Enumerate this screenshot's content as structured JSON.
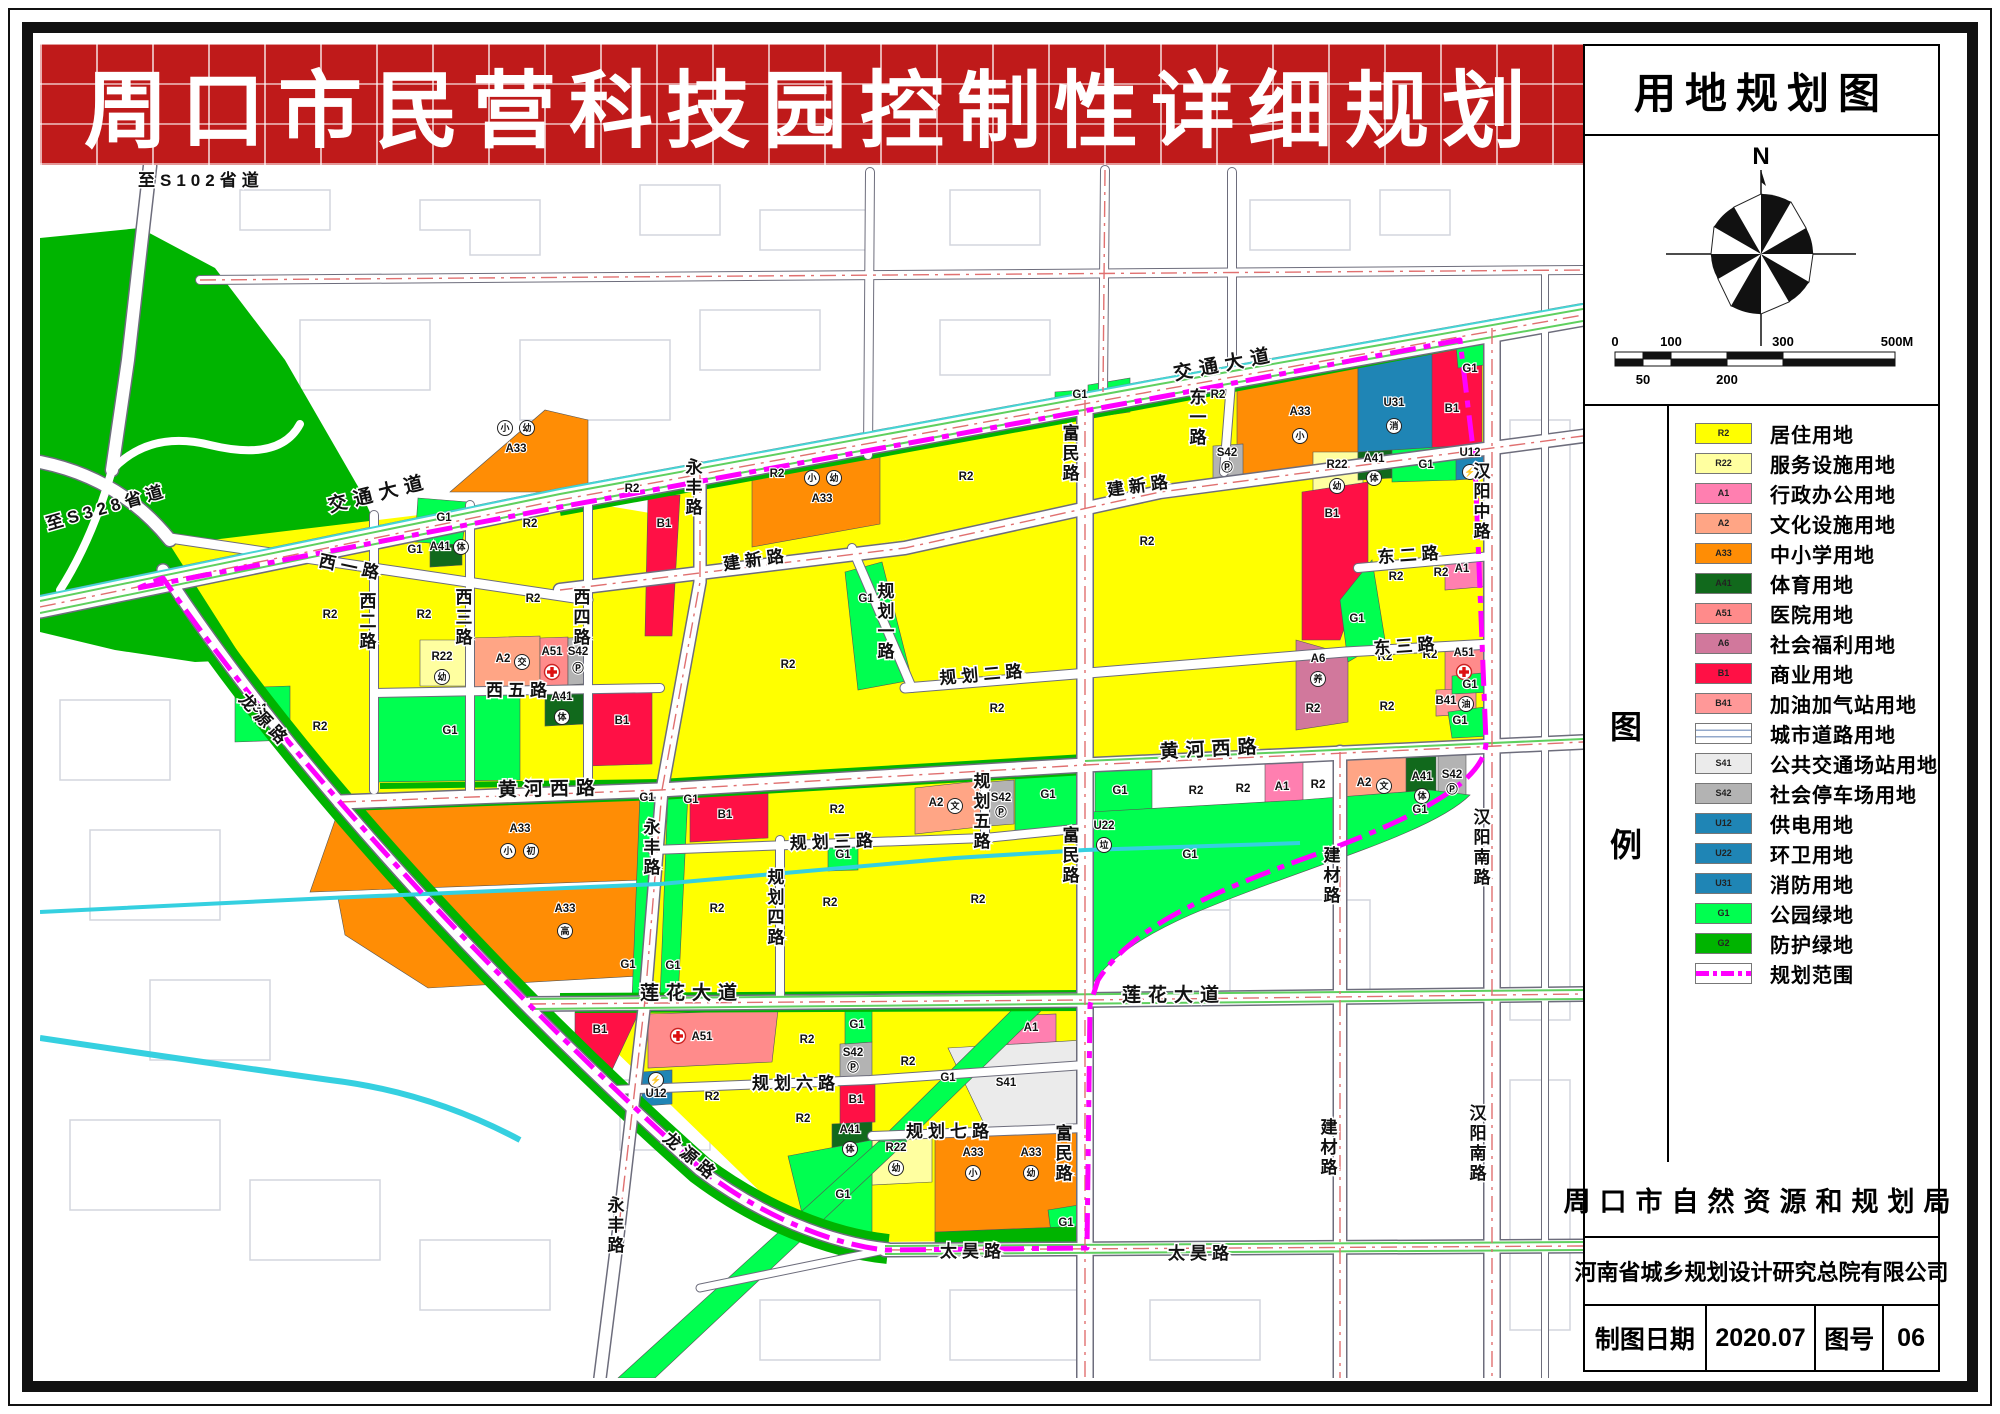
{
  "banner": {
    "title": "周口市民营科技园控制性详细规划"
  },
  "panel": {
    "title": "用地规划图",
    "compass_north": "N",
    "scale": {
      "ticks_top": [
        "0",
        "100",
        "300",
        "500M"
      ],
      "ticks_bottom": [
        "50",
        "200"
      ]
    },
    "legend_col": [
      "图",
      "例"
    ],
    "legend": [
      {
        "code": "R2",
        "color": "#ffff00",
        "label": "居住用地"
      },
      {
        "code": "R22",
        "color": "#ffffa0",
        "label": "服务设施用地"
      },
      {
        "code": "A1",
        "color": "#ff7fb0",
        "label": "行政办公用地"
      },
      {
        "code": "A2",
        "color": "#ffa585",
        "label": "文化设施用地"
      },
      {
        "code": "A33",
        "color": "#ff8d05",
        "label": "中小学用地"
      },
      {
        "code": "A41",
        "color": "#11691c",
        "label": "体育用地"
      },
      {
        "code": "A51",
        "color": "#ff8b8b",
        "label": "医院用地"
      },
      {
        "code": "A6",
        "color": "#d1789c",
        "label": "社会福利用地"
      },
      {
        "code": "B1",
        "color": "#ff1045",
        "label": "商业用地"
      },
      {
        "code": "B41",
        "color": "#ff9898",
        "label": "加油加气站用地"
      },
      {
        "code": "",
        "color": "road",
        "label": "城市道路用地"
      },
      {
        "code": "S41",
        "color": "#ebebeb",
        "label": "公共交通场站用地"
      },
      {
        "code": "S42",
        "color": "#b3b3b3",
        "label": "社会停车场用地"
      },
      {
        "code": "U12",
        "color": "#1f85b5",
        "label": "供电用地"
      },
      {
        "code": "U22",
        "color": "#1f85b5",
        "label": "环卫用地"
      },
      {
        "code": "U31",
        "color": "#1f85b5",
        "label": "消防用地"
      },
      {
        "code": "G1",
        "color": "#00ff50",
        "label": "公园绿地"
      },
      {
        "code": "G2",
        "color": "#00b400",
        "label": "防护绿地"
      },
      {
        "code": "",
        "color": "boundary",
        "label": "规划范围"
      }
    ],
    "authority": "周口市自然资源和规划局",
    "institute": "河南省城乡规划设计研究总院有限公司",
    "footer": {
      "date_label": "制图日期",
      "date_value": "2020.07",
      "sheet_label": "图号",
      "sheet_value": "06"
    }
  },
  "map": {
    "road_labels": [
      {
        "t": "至S102省道",
        "x": 138,
        "y": 186,
        "s": 20,
        "ls": 2
      },
      {
        "t": "至S328省道",
        "x": 48,
        "y": 530,
        "s": 20,
        "r": -16,
        "ls": 2
      },
      {
        "t": "交通大道",
        "x": 330,
        "y": 512,
        "r": -14,
        "big": 1
      },
      {
        "t": "交通大道",
        "x": 1175,
        "y": 380,
        "r": -11,
        "big": 1
      },
      {
        "t": "西一路",
        "x": 318,
        "y": 566,
        "r": 12
      },
      {
        "t": "西二路",
        "x": 366,
        "y": 592,
        "v": 1
      },
      {
        "t": "西三路",
        "x": 462,
        "y": 588,
        "v": 1
      },
      {
        "t": "西四路",
        "x": 580,
        "y": 588,
        "v": 1
      },
      {
        "t": "西五路",
        "x": 486,
        "y": 696
      },
      {
        "t": "永丰路",
        "x": 692,
        "y": 458,
        "v": 1
      },
      {
        "t": "永丰路",
        "x": 650,
        "y": 818,
        "v": 1
      },
      {
        "t": "永丰路",
        "x": 614,
        "y": 1196,
        "v": 1
      },
      {
        "t": "建新路",
        "x": 724,
        "y": 570,
        "r": -8
      },
      {
        "t": "建新路",
        "x": 1108,
        "y": 496,
        "r": -8
      },
      {
        "t": "规划一路",
        "x": 884,
        "y": 582,
        "v": 1
      },
      {
        "t": "规划二路",
        "x": 940,
        "y": 684,
        "r": -5
      },
      {
        "t": "黄河西路",
        "x": 498,
        "y": 796,
        "r": -1,
        "big": 1
      },
      {
        "t": "黄河西路",
        "x": 1160,
        "y": 758,
        "r": -3,
        "big": 1
      },
      {
        "t": "规划三路",
        "x": 790,
        "y": 849,
        "r": -2
      },
      {
        "t": "规划四路",
        "x": 774,
        "y": 868,
        "v": 1
      },
      {
        "t": "规划五路",
        "x": 980,
        "y": 772,
        "v": 1
      },
      {
        "t": "富民路",
        "x": 1069,
        "y": 424,
        "v": 1
      },
      {
        "t": "富民路",
        "x": 1069,
        "y": 826,
        "v": 1
      },
      {
        "t": "富民路",
        "x": 1062,
        "y": 1124,
        "v": 1
      },
      {
        "t": "莲花大道",
        "x": 640,
        "y": 999,
        "big": 1
      },
      {
        "t": "莲花大道",
        "x": 1122,
        "y": 1001,
        "big": 1
      },
      {
        "t": "规划六路",
        "x": 752,
        "y": 1089
      },
      {
        "t": "规划七路",
        "x": 906,
        "y": 1137
      },
      {
        "t": "龙源路",
        "x": 238,
        "y": 700,
        "r": 47
      },
      {
        "t": "龙源路",
        "x": 662,
        "y": 1140,
        "r": 40
      },
      {
        "t": "太昊路",
        "x": 940,
        "y": 1257
      },
      {
        "t": "太昊路",
        "x": 1168,
        "y": 1259
      },
      {
        "t": "东一路",
        "x": 1196,
        "y": 388,
        "v": 1
      },
      {
        "t": "东二路",
        "x": 1378,
        "y": 563,
        "r": -4
      },
      {
        "t": "东三路",
        "x": 1374,
        "y": 654,
        "r": -4
      },
      {
        "t": "汉阳中路",
        "x": 1480,
        "y": 462,
        "v": 1
      },
      {
        "t": "汉阳南路",
        "x": 1480,
        "y": 808,
        "v": 1
      },
      {
        "t": "汉阳南路",
        "x": 1476,
        "y": 1104,
        "v": 1
      },
      {
        "t": "建材路",
        "x": 1330,
        "y": 846,
        "v": 1
      },
      {
        "t": "建材路",
        "x": 1327,
        "y": 1118,
        "v": 1
      }
    ],
    "parcel_labels": [
      {
        "t": "G1",
        "x": 444,
        "y": 521
      },
      {
        "t": "A41",
        "x": 440,
        "y": 550
      },
      {
        "t": "体",
        "c": 1,
        "x": 461,
        "y": 547
      },
      {
        "t": "R2",
        "x": 530,
        "y": 527
      },
      {
        "t": "B1",
        "x": 664,
        "y": 527
      },
      {
        "t": "小",
        "c": 1,
        "x": 505,
        "y": 428
      },
      {
        "t": "幼",
        "c": 1,
        "x": 527,
        "y": 428
      },
      {
        "t": "A33",
        "x": 516,
        "y": 452
      },
      {
        "t": "R2",
        "x": 632,
        "y": 492
      },
      {
        "t": "R2",
        "x": 777,
        "y": 477
      },
      {
        "t": "小",
        "c": 1,
        "x": 812,
        "y": 478
      },
      {
        "t": "幼",
        "c": 1,
        "x": 834,
        "y": 478
      },
      {
        "t": "A33",
        "x": 822,
        "y": 502
      },
      {
        "t": "R2",
        "x": 966,
        "y": 480
      },
      {
        "t": "G1",
        "x": 1080,
        "y": 398
      },
      {
        "t": "R2",
        "x": 1218,
        "y": 398
      },
      {
        "t": "A33",
        "x": 1300,
        "y": 415
      },
      {
        "t": "小",
        "c": 1,
        "x": 1300,
        "y": 436
      },
      {
        "t": "S42",
        "x": 1227,
        "y": 456
      },
      {
        "t": "Ⓟ",
        "x": 1227,
        "y": 471
      },
      {
        "t": "R22",
        "x": 1337,
        "y": 468
      },
      {
        "t": "幼",
        "c": 1,
        "x": 1337,
        "y": 486
      },
      {
        "t": "U31",
        "x": 1394,
        "y": 406
      },
      {
        "t": "消",
        "c": 1,
        "x": 1394,
        "y": 426
      },
      {
        "t": "B1",
        "x": 1452,
        "y": 412
      },
      {
        "t": "G1",
        "x": 1470,
        "y": 372
      },
      {
        "t": "A41",
        "x": 1374,
        "y": 462
      },
      {
        "t": "体",
        "c": 1,
        "x": 1374,
        "y": 478
      },
      {
        "t": "G1",
        "x": 1426,
        "y": 468
      },
      {
        "t": "U12",
        "x": 1470,
        "y": 456
      },
      {
        "t": "⚡",
        "c": 1,
        "x": 1470,
        "y": 472
      },
      {
        "t": "R2",
        "x": 330,
        "y": 618
      },
      {
        "t": "R2",
        "x": 424,
        "y": 618
      },
      {
        "t": "R22",
        "x": 442,
        "y": 660
      },
      {
        "t": "幼",
        "c": 1,
        "x": 442,
        "y": 677
      },
      {
        "t": "A2",
        "x": 503,
        "y": 662
      },
      {
        "t": "交",
        "c": 1,
        "x": 522,
        "y": 662
      },
      {
        "t": "A51",
        "x": 552,
        "y": 655
      },
      {
        "t": "✚",
        "cross": 1,
        "x": 552,
        "y": 672
      },
      {
        "t": "S42",
        "x": 578,
        "y": 655
      },
      {
        "t": "Ⓟ",
        "x": 578,
        "y": 672
      },
      {
        "t": "R2",
        "x": 533,
        "y": 602
      },
      {
        "t": "G1",
        "x": 415,
        "y": 553
      },
      {
        "t": "G1",
        "x": 260,
        "y": 712
      },
      {
        "t": "R2",
        "x": 320,
        "y": 730
      },
      {
        "t": "G1",
        "x": 450,
        "y": 734
      },
      {
        "t": "A41",
        "x": 562,
        "y": 700
      },
      {
        "t": "体",
        "c": 1,
        "x": 562,
        "y": 717
      },
      {
        "t": "B1",
        "x": 622,
        "y": 724
      },
      {
        "t": "R2",
        "x": 788,
        "y": 668
      },
      {
        "t": "G1",
        "x": 866,
        "y": 602
      },
      {
        "t": "R2",
        "x": 997,
        "y": 712
      },
      {
        "t": "R2",
        "x": 1147,
        "y": 545
      },
      {
        "t": "B1",
        "x": 1332,
        "y": 517
      },
      {
        "t": "G1",
        "x": 1357,
        "y": 622
      },
      {
        "t": "A6",
        "x": 1318,
        "y": 662
      },
      {
        "t": "养",
        "c": 1,
        "x": 1318,
        "y": 679
      },
      {
        "t": "R2",
        "x": 1396,
        "y": 580
      },
      {
        "t": "R2",
        "x": 1441,
        "y": 576
      },
      {
        "t": "A1",
        "x": 1462,
        "y": 572
      },
      {
        "t": "R2",
        "x": 1385,
        "y": 660
      },
      {
        "t": "R2",
        "x": 1430,
        "y": 658
      },
      {
        "t": "A51",
        "x": 1464,
        "y": 656
      },
      {
        "t": "✚",
        "cross": 1,
        "x": 1464,
        "y": 672
      },
      {
        "t": "B41",
        "x": 1446,
        "y": 704
      },
      {
        "t": "油",
        "c": 1,
        "x": 1466,
        "y": 704
      },
      {
        "t": "G1",
        "x": 1470,
        "y": 688
      },
      {
        "t": "G1",
        "x": 1460,
        "y": 724
      },
      {
        "t": "R2",
        "x": 1313,
        "y": 712
      },
      {
        "t": "R2",
        "x": 1387,
        "y": 710
      },
      {
        "t": "G1",
        "x": 1120,
        "y": 794
      },
      {
        "t": "R2",
        "x": 1196,
        "y": 794
      },
      {
        "t": "R2",
        "x": 1243,
        "y": 792
      },
      {
        "t": "A1",
        "x": 1282,
        "y": 790
      },
      {
        "t": "R2",
        "x": 1318,
        "y": 788
      },
      {
        "t": "A2",
        "x": 1364,
        "y": 786
      },
      {
        "t": "文",
        "c": 1,
        "x": 1384,
        "y": 786
      },
      {
        "t": "A41",
        "x": 1422,
        "y": 780
      },
      {
        "t": "体",
        "c": 1,
        "x": 1422,
        "y": 796
      },
      {
        "t": "S42",
        "x": 1452,
        "y": 778
      },
      {
        "t": "Ⓟ",
        "x": 1452,
        "y": 793
      },
      {
        "t": "G1",
        "x": 1420,
        "y": 813
      },
      {
        "t": "G1",
        "x": 1190,
        "y": 858
      },
      {
        "t": "U22",
        "x": 1104,
        "y": 829
      },
      {
        "t": "垃",
        "c": 1,
        "x": 1104,
        "y": 845
      },
      {
        "t": "A33",
        "x": 520,
        "y": 832
      },
      {
        "t": "小",
        "c": 1,
        "x": 508,
        "y": 851
      },
      {
        "t": "初",
        "c": 1,
        "x": 531,
        "y": 851
      },
      {
        "t": "A33",
        "x": 565,
        "y": 912
      },
      {
        "t": "高",
        "c": 1,
        "x": 565,
        "y": 931
      },
      {
        "t": "G1",
        "x": 647,
        "y": 801
      },
      {
        "t": "G1",
        "x": 691,
        "y": 803
      },
      {
        "t": "G1",
        "x": 628,
        "y": 968
      },
      {
        "t": "G1",
        "x": 673,
        "y": 969
      },
      {
        "t": "B1",
        "x": 725,
        "y": 818
      },
      {
        "t": "R2",
        "x": 837,
        "y": 813
      },
      {
        "t": "A2",
        "x": 936,
        "y": 806
      },
      {
        "t": "文",
        "c": 1,
        "x": 955,
        "y": 806
      },
      {
        "t": "S42",
        "x": 1001,
        "y": 801
      },
      {
        "t": "Ⓟ",
        "x": 1001,
        "y": 816
      },
      {
        "t": "G1",
        "x": 1048,
        "y": 798
      },
      {
        "t": "G1",
        "x": 843,
        "y": 858
      },
      {
        "t": "R2",
        "x": 717,
        "y": 912
      },
      {
        "t": "R2",
        "x": 830,
        "y": 906
      },
      {
        "t": "R2",
        "x": 978,
        "y": 903
      },
      {
        "t": "B1",
        "x": 600,
        "y": 1033
      },
      {
        "t": "✚",
        "cross": 1,
        "x": 678,
        "y": 1036
      },
      {
        "t": "A51",
        "x": 702,
        "y": 1040
      },
      {
        "t": "⚡",
        "c": 1,
        "x": 656,
        "y": 1080
      },
      {
        "t": "U12",
        "x": 656,
        "y": 1097
      },
      {
        "t": "R2",
        "x": 712,
        "y": 1100
      },
      {
        "t": "R2",
        "x": 807,
        "y": 1043
      },
      {
        "t": "G1",
        "x": 857,
        "y": 1028
      },
      {
        "t": "S42",
        "x": 853,
        "y": 1056
      },
      {
        "t": "Ⓟ",
        "x": 853,
        "y": 1071
      },
      {
        "t": "B1",
        "x": 856,
        "y": 1103
      },
      {
        "t": "A41",
        "x": 850,
        "y": 1133
      },
      {
        "t": "体",
        "c": 1,
        "x": 850,
        "y": 1149
      },
      {
        "t": "R2",
        "x": 803,
        "y": 1122
      },
      {
        "t": "G1",
        "x": 843,
        "y": 1198
      },
      {
        "t": "A1",
        "x": 1031,
        "y": 1031
      },
      {
        "t": "R2",
        "x": 908,
        "y": 1065
      },
      {
        "t": "G1",
        "x": 948,
        "y": 1081
      },
      {
        "t": "S41",
        "x": 1006,
        "y": 1086
      },
      {
        "t": "R22",
        "x": 896,
        "y": 1151
      },
      {
        "t": "幼",
        "c": 1,
        "x": 896,
        "y": 1168
      },
      {
        "t": "A33",
        "x": 973,
        "y": 1156
      },
      {
        "t": "小",
        "c": 1,
        "x": 973,
        "y": 1173
      },
      {
        "t": "A33",
        "x": 1031,
        "y": 1156
      },
      {
        "t": "幼",
        "c": 1,
        "x": 1031,
        "y": 1173
      },
      {
        "t": "G1",
        "x": 1066,
        "y": 1226
      }
    ]
  }
}
